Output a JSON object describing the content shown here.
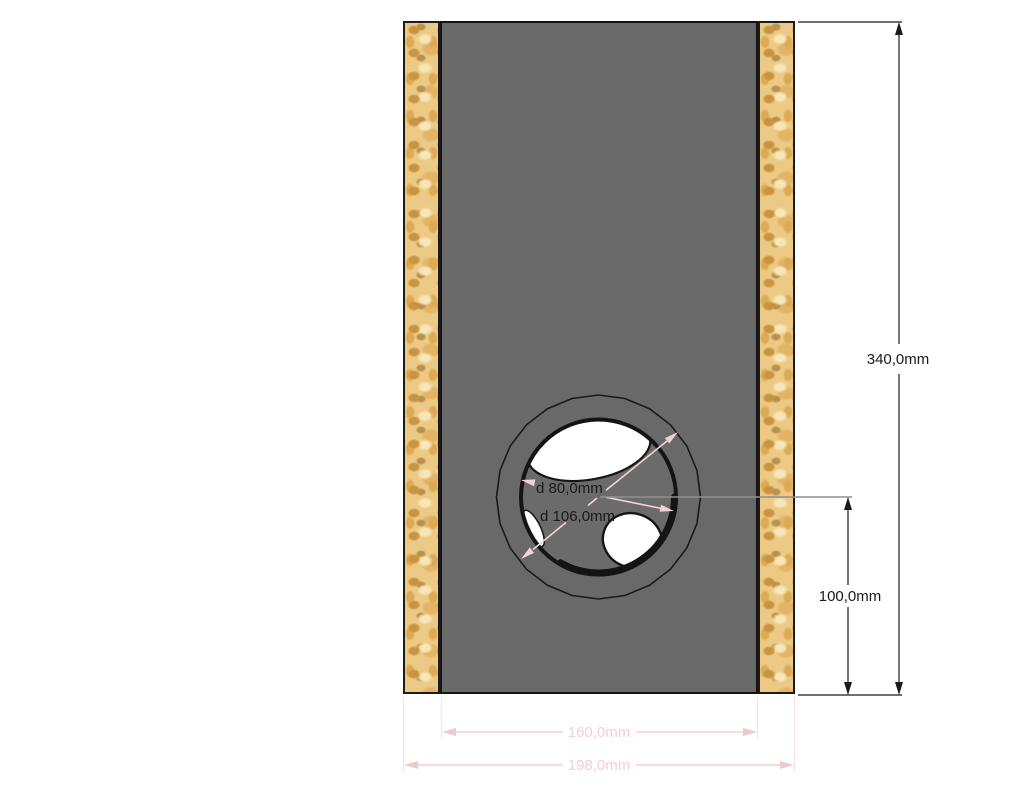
{
  "drawing": {
    "type": "speaker-enclosure-cross-section",
    "labels": {
      "total_height": "340,0mm",
      "hole_center_from_bottom": "100,0mm",
      "inner_panel_width": "160,0mm",
      "outer_total_width": "198,0mm",
      "hole_diameter": "d 80,0mm",
      "ring_diameter": "d 106,0mm"
    },
    "colors": {
      "panel_gray": "#696969",
      "wood_base_tan": "#ecca85",
      "dimension_pink": "#f2cfcf",
      "dimension_black": "#1a1a1a",
      "extension_gray": "#8f8f8f",
      "background": "#ffffff"
    }
  }
}
